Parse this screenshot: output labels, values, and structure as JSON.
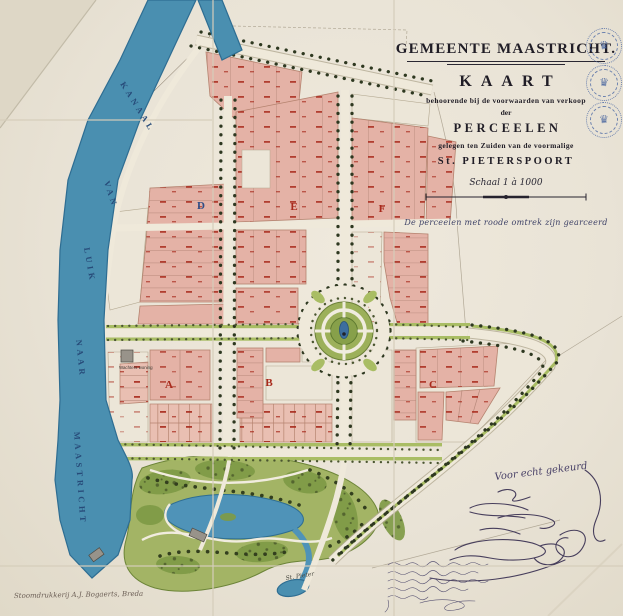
{
  "title_block": {
    "municipality": "GEMEENTE MAASTRICHT.",
    "map_word": "KAART",
    "line1": "behoorende bij de voorwaarden van verkoop",
    "line2": "der",
    "parcels_word": "PERCEELEN",
    "line3": "gelegen ten Zuiden van de voormalige",
    "gate_name": "St. PIETERSPOORT",
    "scale_label": "Schaal 1 à 1000",
    "note": "De perceelen met roode omtrek zijn gearceerd"
  },
  "canal_labels": [
    "KANAAL",
    "VAN",
    "LUIK",
    "NAAR",
    "MAASTRICHT"
  ],
  "block_labels": [
    "A",
    "B",
    "C",
    "D",
    "E",
    "F"
  ],
  "annotations": {
    "certified": "Voor echt gekeurd",
    "printer": "Stoomdrukkerij A.J. Bogaerts, Breda",
    "guard_house": "Wachters woning",
    "road_to": "St. Pieter"
  },
  "stamps": {
    "crown": "♛"
  },
  "colors": {
    "canal": "#4a8fb0",
    "parcel_pink": "#e4b2a6",
    "parcel_red": "#a8291b",
    "park_green": "#8aa04c",
    "road": "#efe9da",
    "title_ink": "#201d26",
    "script_ink": "#3d4166",
    "stamp_blue": "#47649e",
    "paper": "#e9e3d6"
  }
}
